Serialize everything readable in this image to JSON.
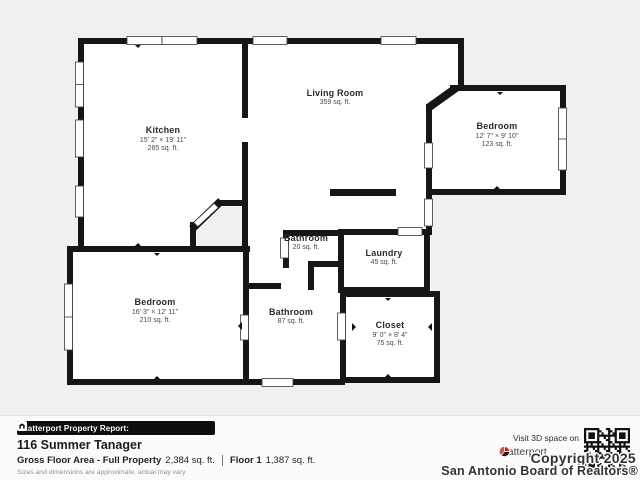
{
  "plan": {
    "rooms": {
      "kitchen": {
        "name": "Kitchen",
        "dims": "15' 2\" × 19' 11\"",
        "area": "285 sq. ft."
      },
      "living_room": {
        "name": "Living Room",
        "area": "359 sq. ft."
      },
      "bedroom_upper": {
        "name": "Bedroom",
        "dims": "12' 7\" × 9' 10\"",
        "area": "123 sq. ft."
      },
      "bathroom_small": {
        "name": "Bathroom",
        "area": "20 sq. ft."
      },
      "laundry": {
        "name": "Laundry",
        "area": "45 sq. ft."
      },
      "bedroom_lower": {
        "name": "Bedroom",
        "dims": "16' 3\" × 12' 11\"",
        "area": "210 sq. ft."
      },
      "bathroom_main": {
        "name": "Bathroom",
        "area": "87 sq. ft."
      },
      "closet": {
        "name": "Closet",
        "dims": "9' 0\" × 8' 4\"",
        "area": "75 sq. ft."
      }
    }
  },
  "footer": {
    "report_label": "Matterport Property Report:",
    "address": "116 Summer Tanager",
    "gross_label": "Gross Floor Area - Full Property",
    "gross_value": "2,384 sq. ft.",
    "floor_label": "Floor 1",
    "floor_value": "1,387 sq. ft.",
    "disclaimer": "Sizes and dimensions are approximate, actual may vary",
    "visit_label": "Visit 3D space on",
    "brand": "Matterport",
    "copyright_line1": "Copyright 2025",
    "copyright_line2": "San Antonio Board of Realtors®"
  },
  "icons": {
    "matterport_house_icon": "matterport-house-icon",
    "matterport_pinwheel_icon": "matterport-pinwheel-icon",
    "qr_code": "qr-code"
  },
  "colors": {
    "wall": "#161616",
    "background": "#f1f0ee",
    "brand_red": "#d11f26"
  }
}
